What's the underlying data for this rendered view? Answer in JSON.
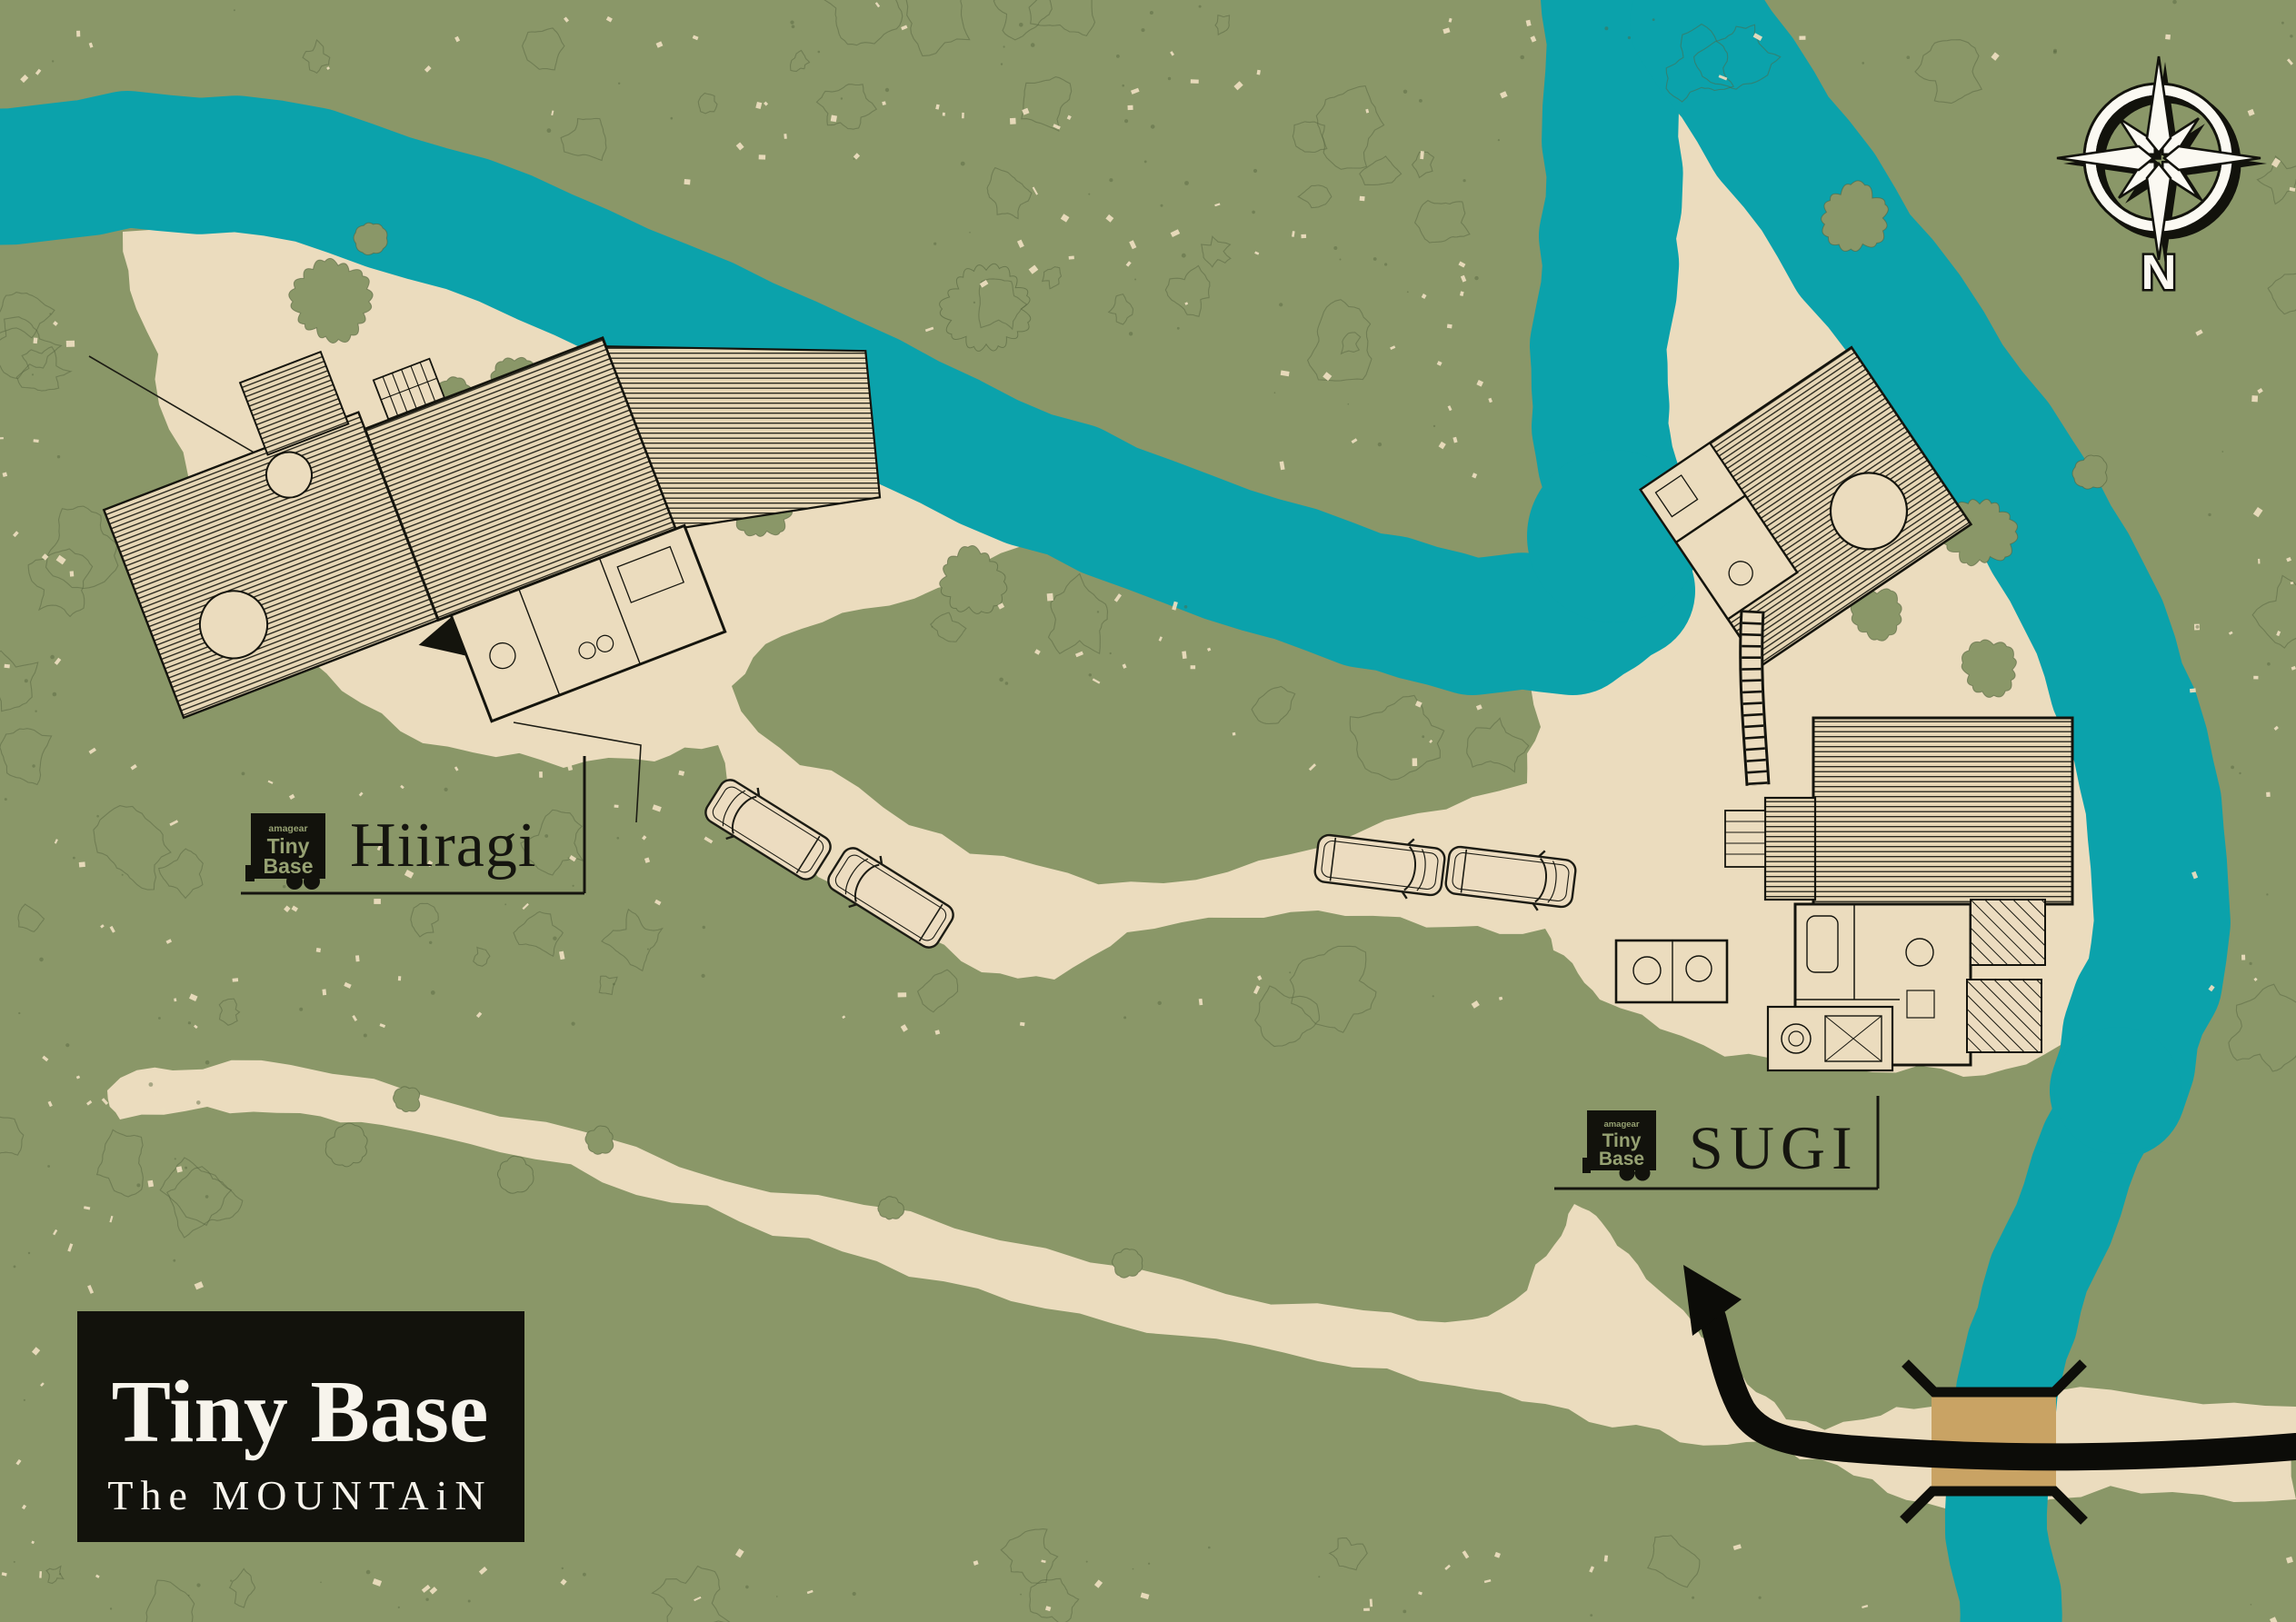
{
  "map": {
    "title_block": {
      "title": "Tiny Base",
      "subtitle": "The MOUNTAiN"
    },
    "compass": {
      "label": "N"
    },
    "sites": [
      {
        "id": "hiiragi",
        "label": "Hiiragi",
        "logo": {
          "brand": "amagear",
          "line1": "Tiny",
          "line2": "Base"
        }
      },
      {
        "id": "sugi",
        "label": "SUGI",
        "logo": {
          "brand": "amagear",
          "line1": "Tiny",
          "line2": "Base"
        }
      }
    ],
    "colors": {
      "forest": "#8a9768",
      "forest_line": "#55643f",
      "sand": "#ebdcbe",
      "river": "#0ba2ab",
      "bridge": "#c9a364",
      "ink": "#12120c",
      "paper": "#f7f4ec",
      "logo_text": "#96a172"
    }
  }
}
